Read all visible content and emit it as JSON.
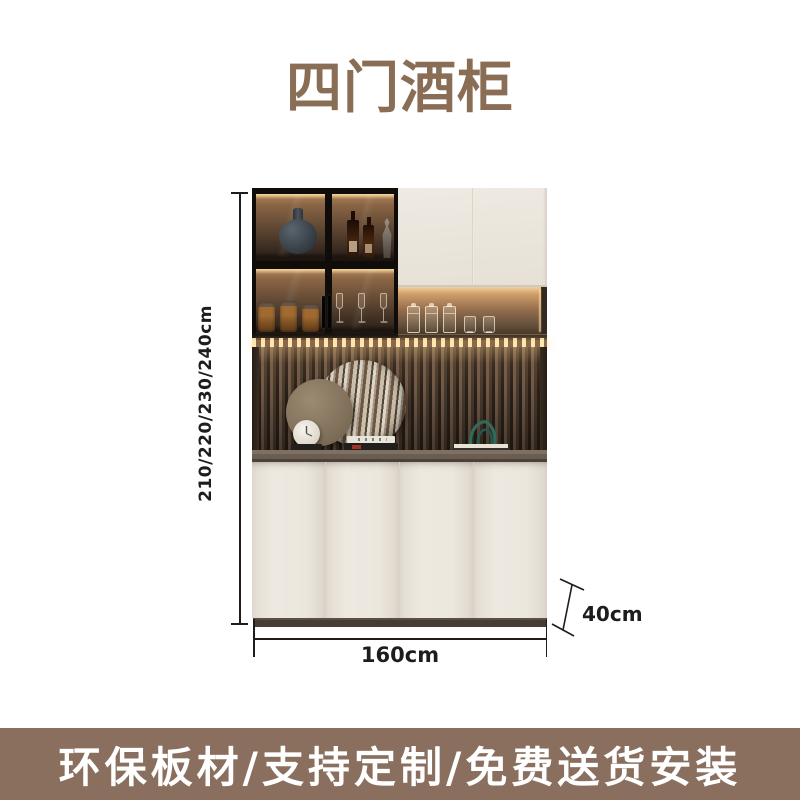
{
  "header": {
    "title": "四门酒柜",
    "title_color": "#8a6d55"
  },
  "product": {
    "dimensions": {
      "height": "210/220/230/240cm",
      "width": "160cm",
      "depth": "40cm"
    },
    "colors": {
      "door_cream": "#eae5dc",
      "glass_frame_dark": "#0f0c0a",
      "interior_glow": "#ffe3b0",
      "slat_light": "#6e5847",
      "slat_dark": "#2a2018",
      "counter": "#6a5d52",
      "plinth": "#463d35",
      "teal_decor": "#2f6b5d",
      "dimension_ink": "#1d1d1d"
    }
  },
  "banner": {
    "text": "环保板材/支持定制/免费送货安装",
    "background": "#8a6f5f",
    "text_color": "#ffffff"
  }
}
